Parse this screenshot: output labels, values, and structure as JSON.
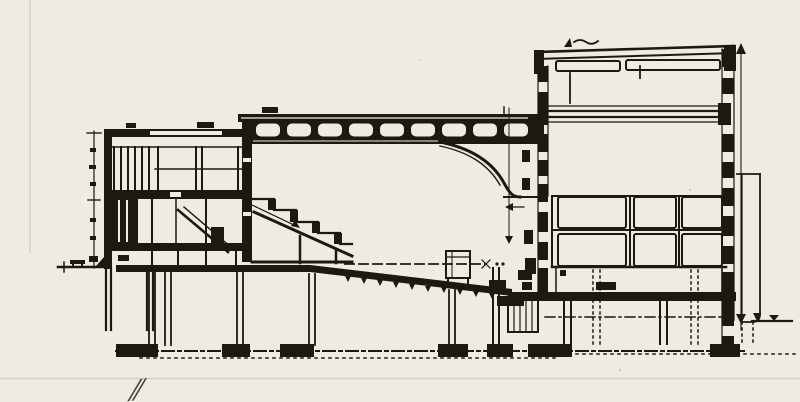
{
  "document": {
    "type": "scanned architectural drawing",
    "subject": "theater building longitudinal section",
    "paper_color": "#eeebe4",
    "ink_color": "#1c1812",
    "handwritten_mark": "⁄⁄"
  },
  "drawing": {
    "parts": [
      "left-dimension-line",
      "left-ground-line",
      "foyer-block",
      "balcony-steps",
      "coffered-roof-truss",
      "ceiling-curve",
      "proscenium-wall",
      "raked-auditorium-floor",
      "datum-dash-line",
      "basement-columns",
      "foundation-line",
      "orchestra-pit",
      "stage-floor",
      "stage-wall-panel-grid",
      "fly-tower",
      "gridiron-level",
      "right-annex",
      "right-dimension-line",
      "right-ground-line"
    ]
  }
}
